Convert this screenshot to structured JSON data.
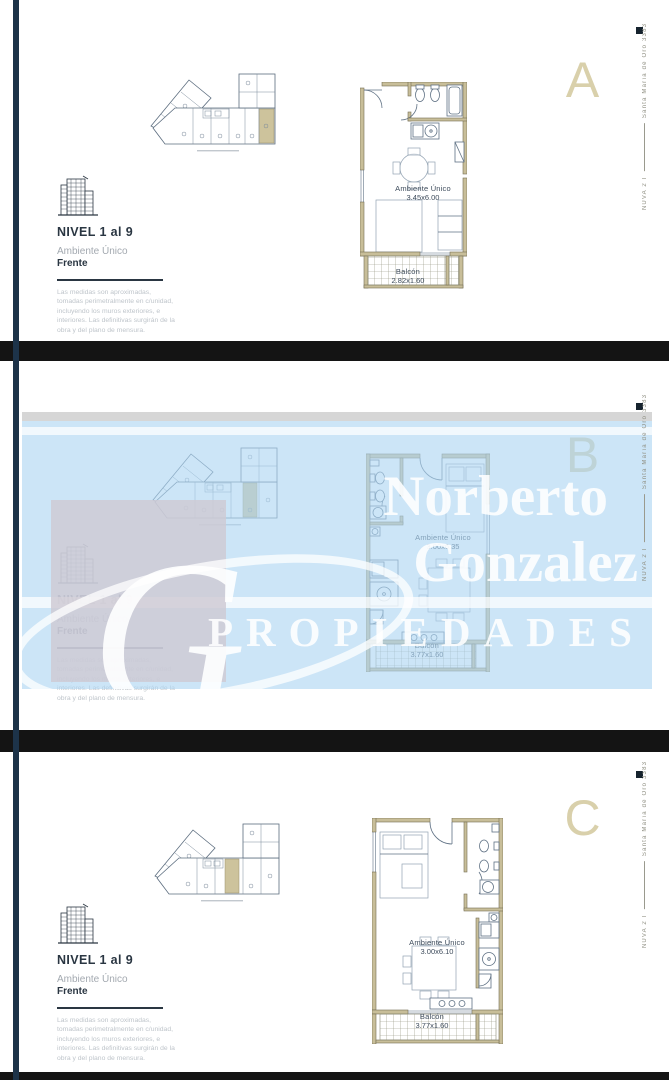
{
  "brand": {
    "watermark_line1": "Norberto",
    "watermark_line2": "Gonzalez",
    "watermark_line3": "PROPIEDADES",
    "logo_letter": "G"
  },
  "side_rail": {
    "project": "NUVA 2 I",
    "address": "Santa María de Oro 3383"
  },
  "info": {
    "level": "NIVEL 1 al 9",
    "unit_type": "Ambiente Único",
    "orientation": "Frente",
    "disclaimer": "Las medidas son aproximadas, tomadas perimetralmente en c/unidad, incluyendo los muros exteriores,  e interiores. Las definitivas surgirán de la obra y del plano de mensura."
  },
  "panels": [
    {
      "letter": "A",
      "room_label": "Ambiente Único",
      "room_dims": "3.45x6.00",
      "balcony_label": "Balcón",
      "balcony_dims": "2.82x1.60"
    },
    {
      "letter": "B",
      "room_label": "Ambiente Único",
      "room_dims": "3.00x6.35",
      "balcony_label": "Balcón",
      "balcony_dims": "3.77x1.60"
    },
    {
      "letter": "C",
      "room_label": "Ambiente Único",
      "room_dims": "3.00x6.10",
      "balcony_label": "Balcón",
      "balcony_dims": "3.77x1.60"
    }
  ],
  "colors": {
    "accent_beige": "#d9d0ab",
    "wall_fill": "#c8be99",
    "plan_line": "#5f7184",
    "navy": "#1d3349",
    "overlay_blue": "#cde3f6",
    "separator_black": "#141414"
  }
}
